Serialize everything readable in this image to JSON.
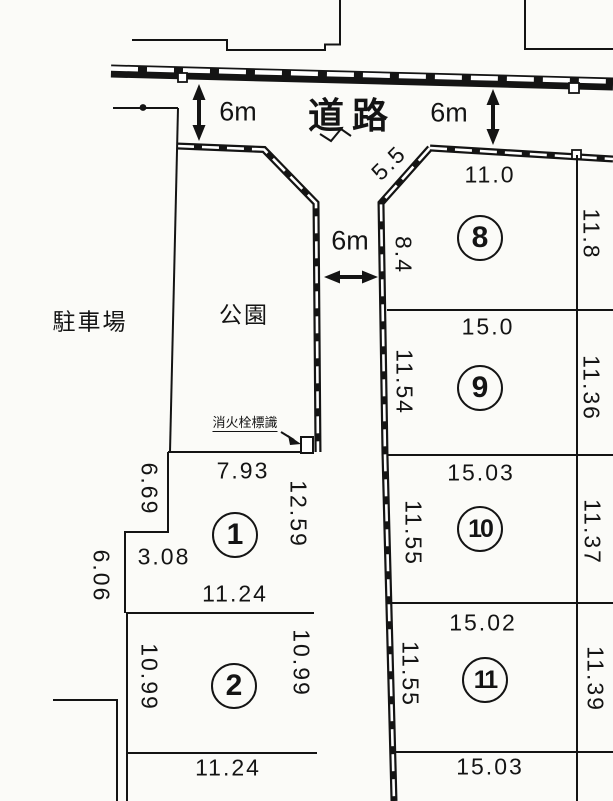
{
  "map": {
    "road_label": "道路",
    "park_label": "公園",
    "parking_label": "駐車場",
    "hydrant_label": "消火栓標識",
    "road_width_top_left": "6m",
    "road_width_top_right": "6m",
    "road_width_middle": "6m"
  },
  "plots": {
    "p1": {
      "number": "1",
      "top": "7.93",
      "left_upper": "6.69",
      "step": "3.08",
      "left_lower": "6.06",
      "right": "12.59",
      "bottom": "11.24"
    },
    "p2": {
      "number": "2",
      "left": "10.99",
      "right": "10.99",
      "bottom": "11.24"
    },
    "p8": {
      "number": "8",
      "diagonal": "5.5",
      "top": "11.0",
      "left": "8.4",
      "right": "11.8"
    },
    "p9": {
      "number": "9",
      "top": "15.0",
      "left": "11.54",
      "right": "11.36"
    },
    "p10": {
      "number": "10",
      "top": "15.03",
      "left": "11.55",
      "right": "11.37"
    },
    "p11": {
      "number": "11",
      "top": "15.02",
      "left": "11.55",
      "right": "11.39",
      "bottom": "15.03"
    }
  },
  "colors": {
    "ink": "#141414",
    "paper": "#fbfbf8"
  }
}
